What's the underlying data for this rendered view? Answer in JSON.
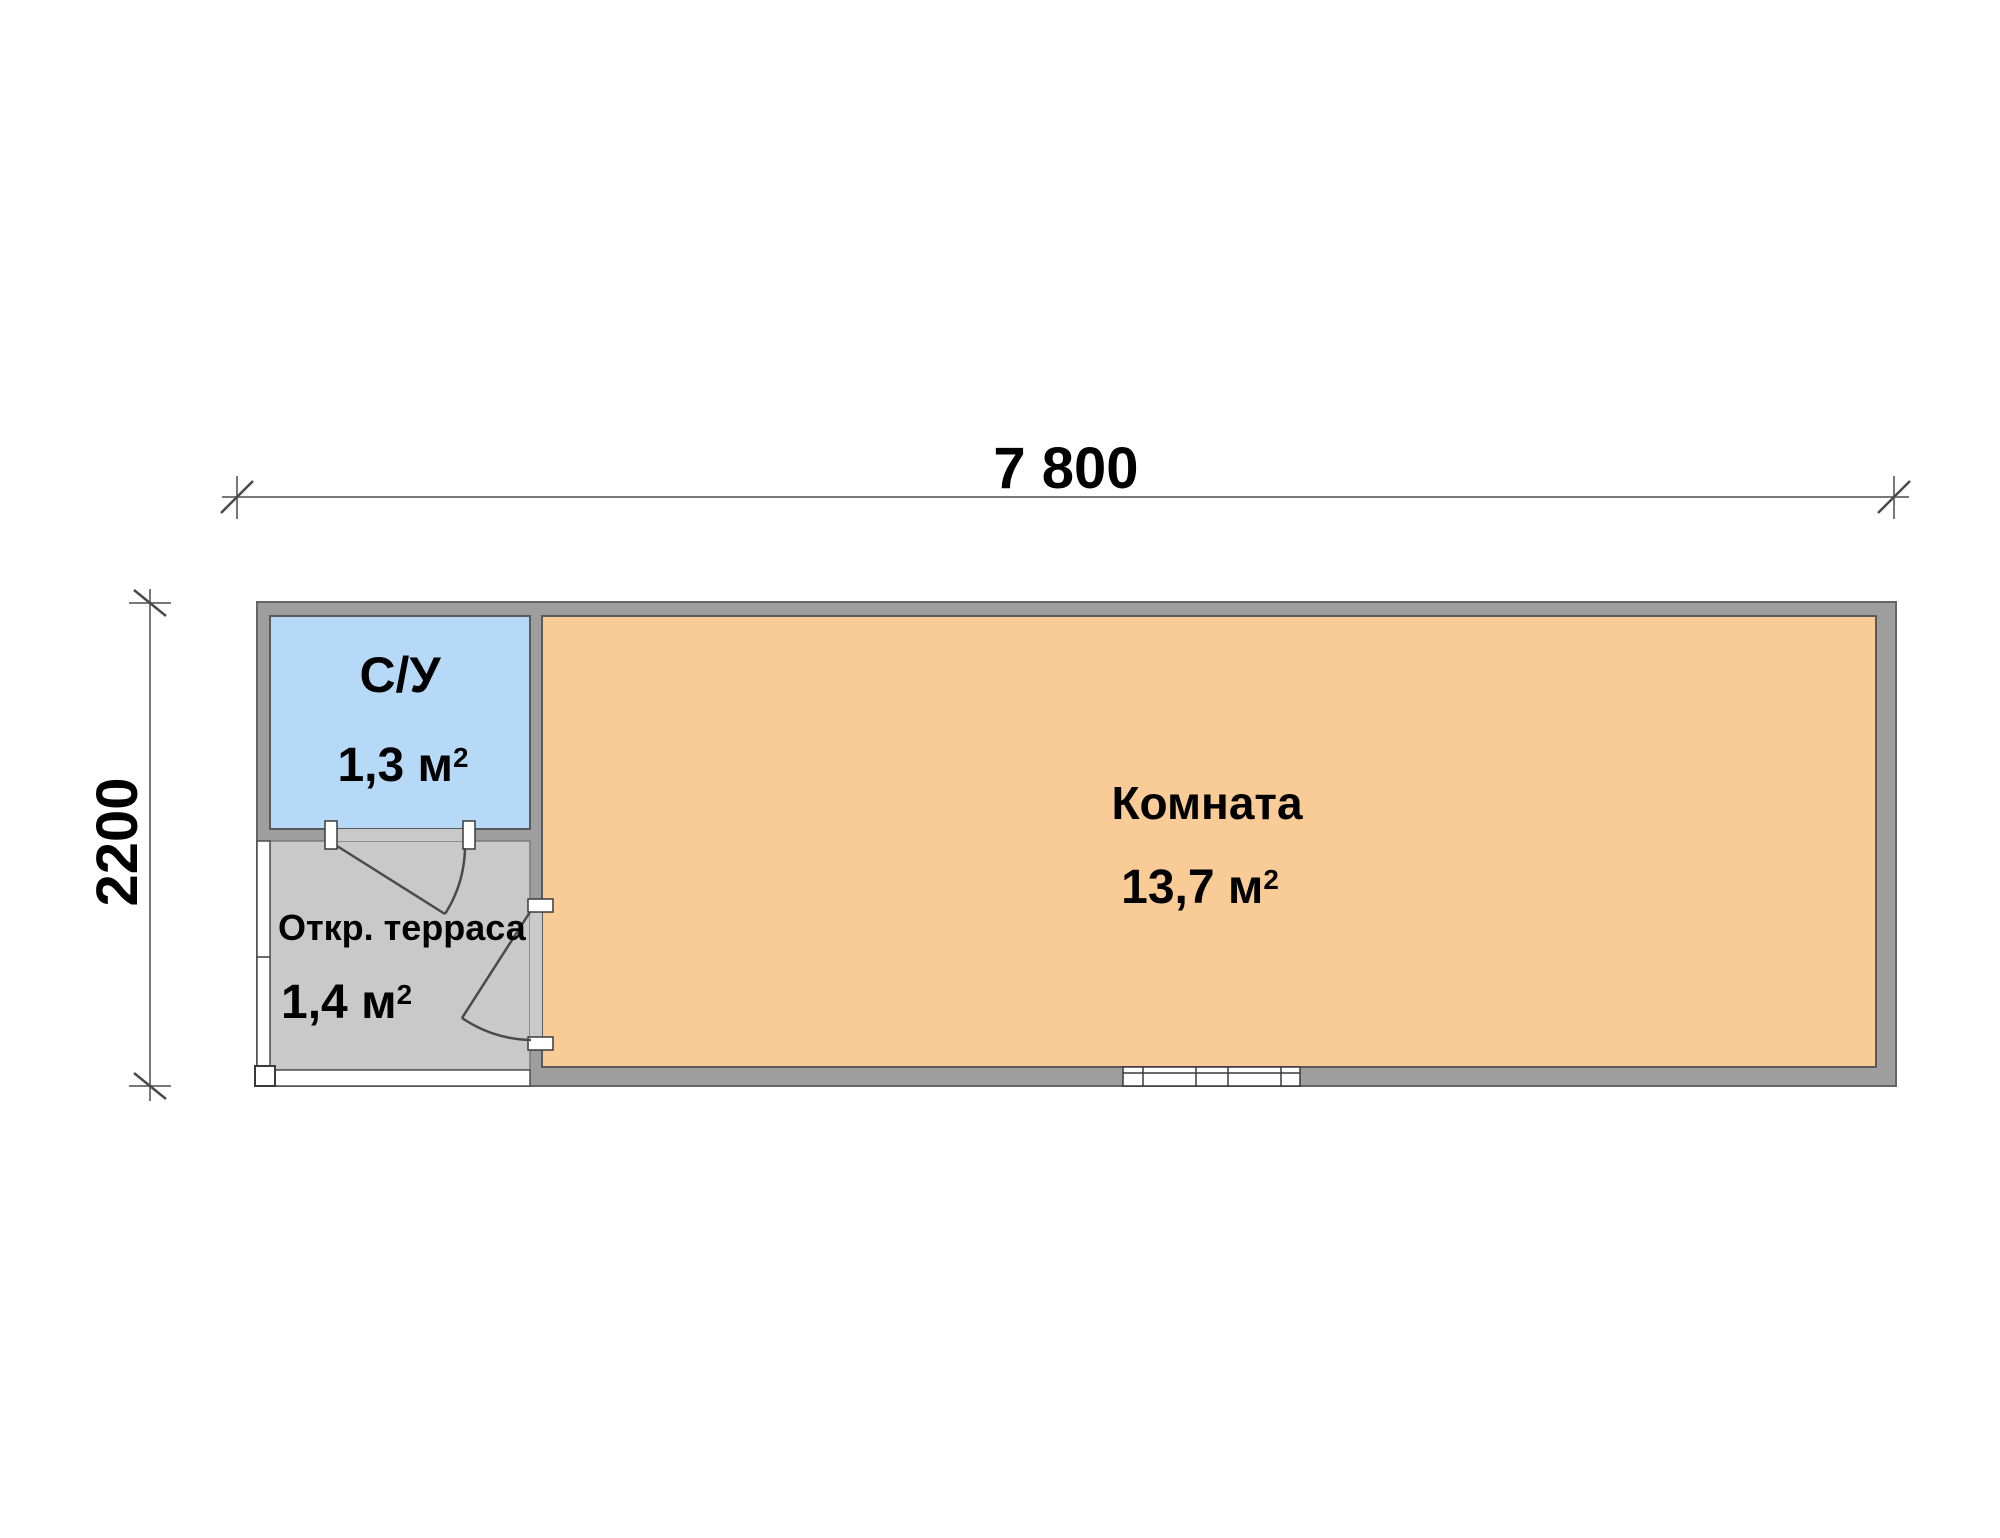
{
  "dimensions": {
    "width": "7 800",
    "height": "2200"
  },
  "rooms": {
    "bathroom": {
      "name": "С/У",
      "area": "1,3 м",
      "area_sup": "2",
      "fill": "#b5d9f6"
    },
    "living": {
      "name": "Комната",
      "area": "13,7 м",
      "area_sup": "2",
      "fill": "#f8cb97"
    },
    "terrace": {
      "name": "Откр. терраса",
      "area": "1,4 м",
      "area_sup": "2",
      "fill": "#c9c9c9"
    }
  },
  "colors": {
    "background": "#ffffff",
    "wall_fill": "#9e9e9e",
    "wall_outline": "#646464",
    "dimension_line": "#787878",
    "label_text": "#000000"
  }
}
